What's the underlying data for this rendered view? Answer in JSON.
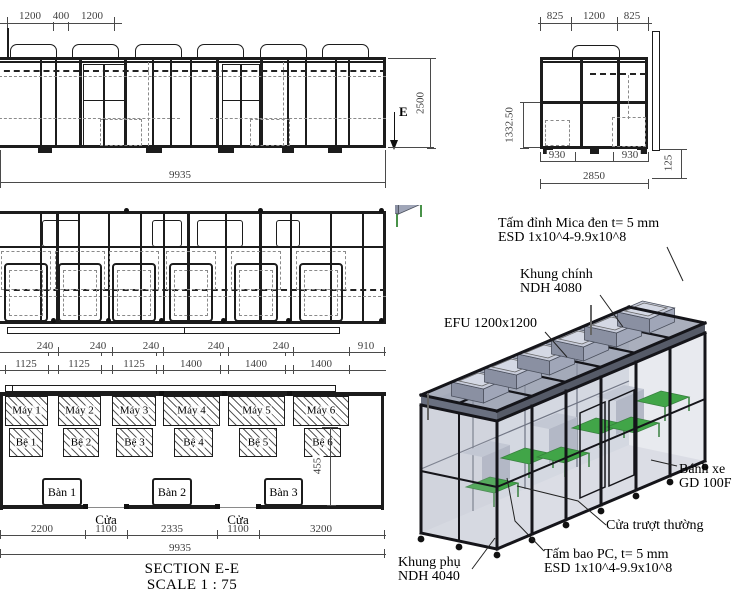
{
  "front": {
    "dims_top": [
      "1200",
      "400",
      "1200"
    ],
    "dim_total": "9935",
    "dim_height": "2500",
    "marker": "E"
  },
  "side": {
    "dims_top": [
      "825",
      "1200",
      "825"
    ],
    "dim_left": "1332.50",
    "dims_bottom": [
      "930",
      "930"
    ],
    "dim_total": "2850",
    "dim_right": "125"
  },
  "plan": {
    "dims_gaps": [
      "240",
      "240",
      "240",
      "240",
      "240"
    ],
    "dim_right_gap": "910",
    "dims_widths": [
      "1125",
      "1125",
      "1125",
      "1400",
      "1400",
      "1400"
    ],
    "machines": [
      "Máy 1",
      "Máy 2",
      "Máy 3",
      "Máy 4",
      "Máy 5",
      "Máy 6"
    ],
    "bases": [
      "Bệ 1",
      "Bệ 2",
      "Bệ 3",
      "Bệ 4",
      "Bệ 5",
      "Bệ 6"
    ],
    "tables": [
      "Bàn 1",
      "Bàn 2",
      "Bàn 3"
    ],
    "doors": [
      "Cửa",
      "Cửa"
    ],
    "dims_bottom": [
      "2200",
      "1100",
      "2335",
      "1100",
      "3200"
    ],
    "dim_total": "9935",
    "dim_offset": "455"
  },
  "title": {
    "name": "SECTION E-E",
    "scale": "SCALE 1 : 75"
  },
  "iso": {
    "ann_top_1": "Tấm đỉnh Mica đen t= 5 mm",
    "ann_top_2": "ESD 1x10^4-9.9x10^8",
    "ann_frame_1": "Khung chính",
    "ann_frame_2": "NDH 4080",
    "ann_efu": "EFU 1200x1200",
    "ann_wheel_1": "Bánh xe",
    "ann_wheel_2": "GD 100F",
    "ann_door": "Cửa trượt thường",
    "ann_panel_1": "Tấm bao PC, t= 5 mm",
    "ann_panel_2": "ESD 1x10^4-9.9x10^8",
    "ann_sub_1": "Khung phụ",
    "ann_sub_2": "NDH 4040"
  },
  "colors": {
    "line": "#1c1c1c",
    "dim": "#4a4a4a",
    "table_green": "#18a018",
    "ffu_gray": "#a0a6b8",
    "panel_gray": "#aeb4c4"
  }
}
